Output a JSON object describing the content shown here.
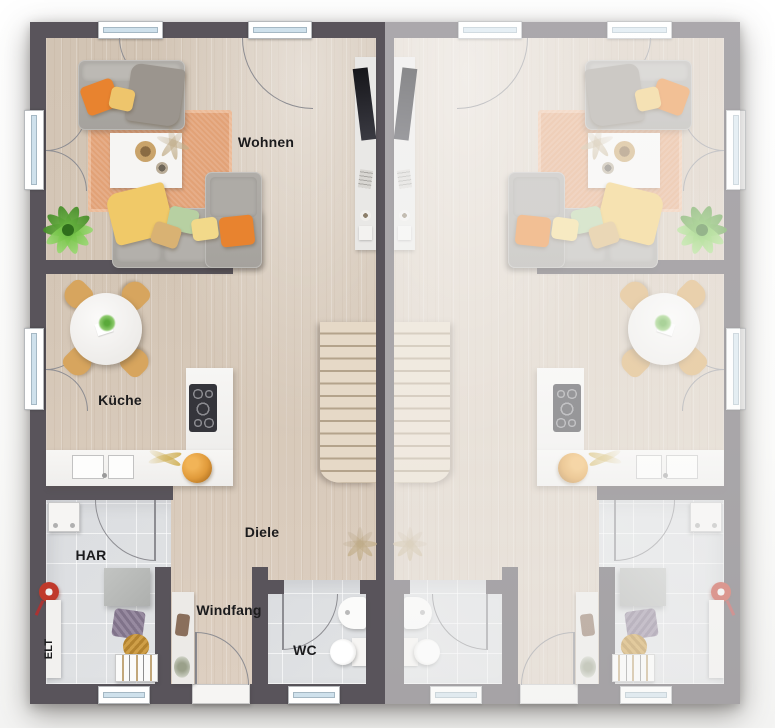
{
  "floorplan": {
    "description": "Ground-floor plan of a semi-detached duplex; left unit labeled, right unit mirrored and faded",
    "rooms": {
      "wohnen": "Wohnen",
      "kueche": "Küche",
      "diele": "Diele",
      "windfang": "Windfang",
      "wc": "WC",
      "har": "HAR",
      "elt": "ELT"
    },
    "colors": {
      "wall": "#59545b",
      "wall_faded": "#a7a5a8",
      "floor_wood": "#d5c7b7",
      "floor_tile": "#dddfe2",
      "glass": "#cfe1ec",
      "arc": "#8d8d92",
      "rug": "#e2a277",
      "sofa": "#a8a5a0",
      "pillow_orange": "#e8832f",
      "pillow_yellow": "#eec56c",
      "pillow_green": "#b7d0a2",
      "pillow_tan": "#d9b273",
      "blanket_yellow": "#f0c968",
      "chair_tan": "#d7a55e",
      "stairs": "#ddcfbc",
      "counter": "#f5f4f2",
      "hob": "#35353b",
      "plant_green": "#63b23c",
      "vacuum_red": "#c0392b"
    }
  }
}
